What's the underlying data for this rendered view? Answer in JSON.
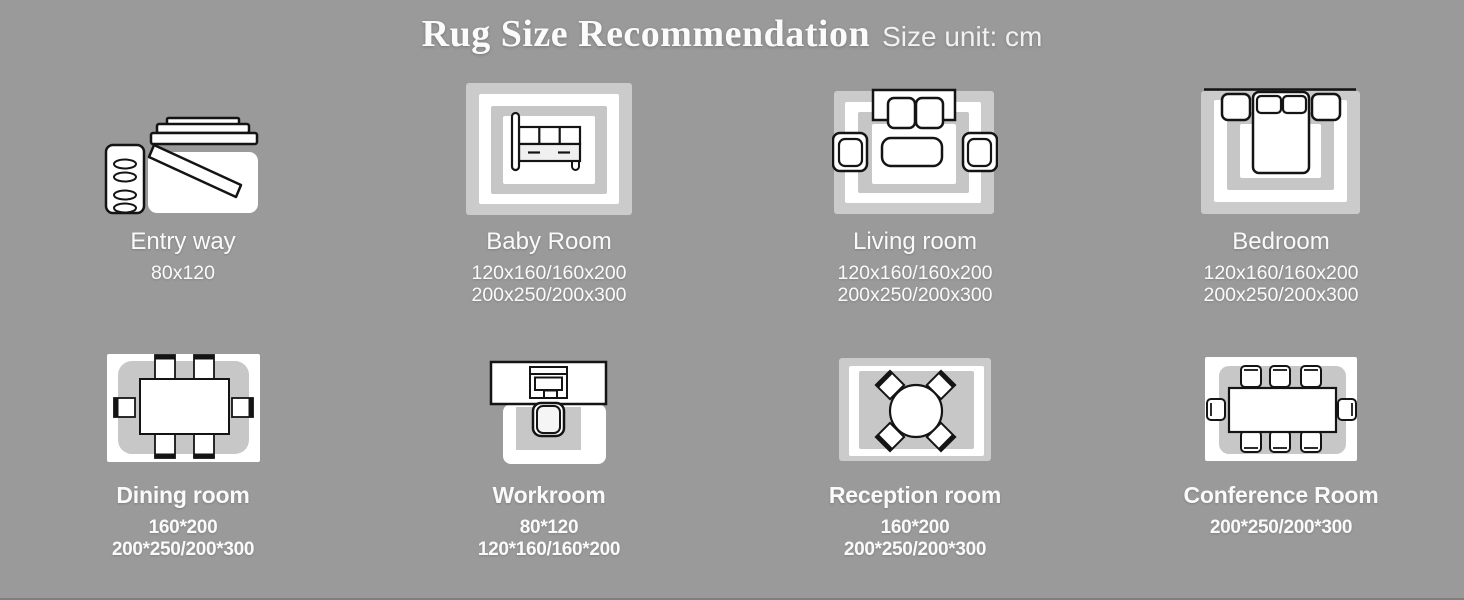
{
  "header": {
    "title": "Rug Size Recommendation",
    "subtitle": "Size unit: cm"
  },
  "colors": {
    "background": "#9a9a9a",
    "rug_light_gray": "#cbcbcb",
    "rug_mid_gray": "#c6c6c6",
    "rug_white": "#ffffff",
    "furniture_outline": "#141414",
    "text": "#fafafa"
  },
  "rooms": [
    {
      "name": "Entry way",
      "icon": "entry-way-icon",
      "sizes": [
        "80x120"
      ]
    },
    {
      "name": "Baby Room",
      "icon": "baby-room-icon",
      "sizes": [
        "120x160/160x200",
        "200x250/200x300"
      ]
    },
    {
      "name": "Living room",
      "icon": "living-room-icon",
      "sizes": [
        "120x160/160x200",
        "200x250/200x300"
      ]
    },
    {
      "name": "Bedroom",
      "icon": "bedroom-icon",
      "sizes": [
        "120x160/160x200",
        "200x250/200x300"
      ]
    },
    {
      "name": "Dining room",
      "icon": "dining-room-icon",
      "sizes": [
        "160*200",
        "200*250/200*300"
      ]
    },
    {
      "name": "Workroom",
      "icon": "workroom-icon",
      "sizes": [
        "80*120",
        "120*160/160*200"
      ]
    },
    {
      "name": "Reception room",
      "icon": "reception-room-icon",
      "sizes": [
        "160*200",
        "200*250/200*300"
      ]
    },
    {
      "name": "Conference Room",
      "icon": "conference-room-icon",
      "sizes": [
        "200*250/200*300"
      ]
    }
  ]
}
